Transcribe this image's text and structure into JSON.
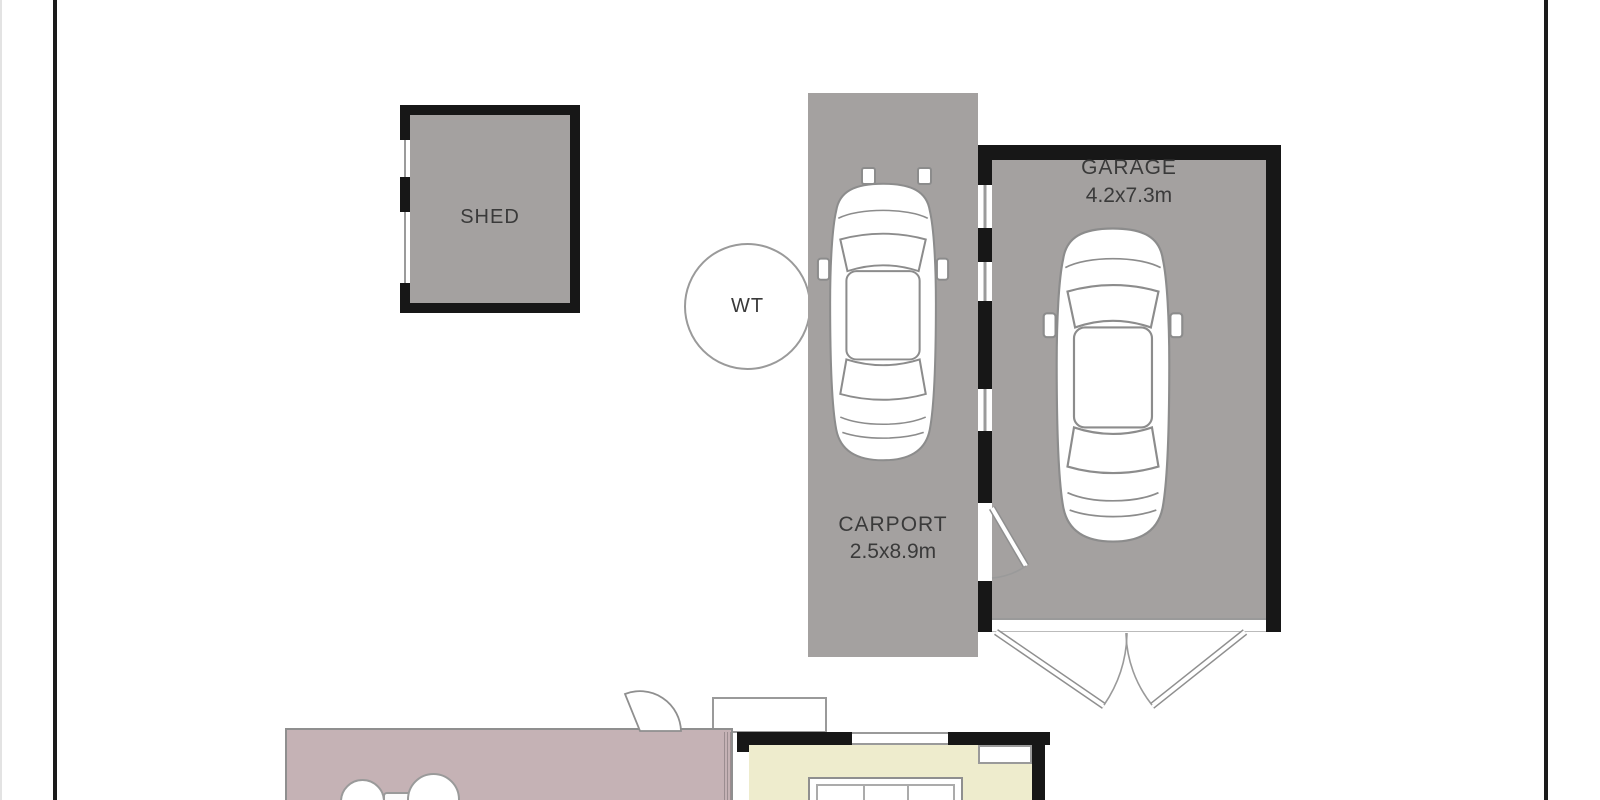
{
  "plan": {
    "title": "residential site floor plan",
    "shed": {
      "label": "SHED"
    },
    "water_tank": {
      "label": "WT"
    },
    "carport": {
      "label": "CARPORT",
      "dimensions": "2.5x8.9m"
    },
    "garage": {
      "label": "GARAGE",
      "dimensions": "4.2x7.3m"
    }
  },
  "colors": {
    "structure_gray": "#a4a1a0",
    "wall_black": "#171717",
    "patio_pink": "#c5b2b5",
    "room_yellow": "#eeeccd",
    "outline_gray": "#9a9a9a",
    "text": "#3a3a3a",
    "background": "#ffffff"
  }
}
